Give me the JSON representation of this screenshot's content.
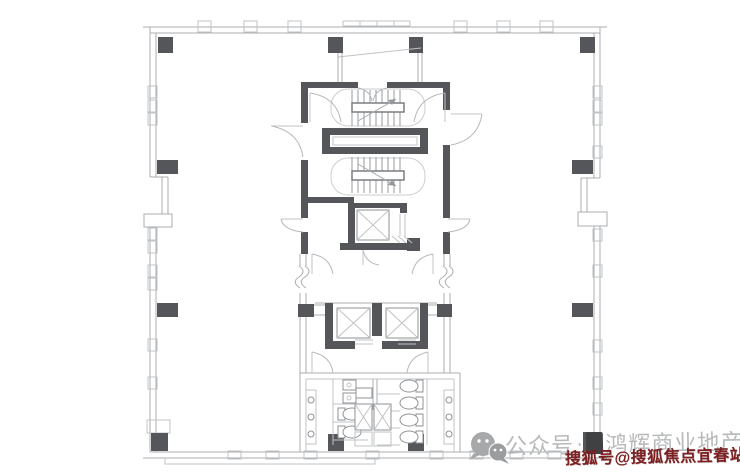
{
  "watermark": {
    "wechat_label": "公众号",
    "separator": "·",
    "brand": "鸿辉商业地产",
    "sohu_line": "搜狐号@搜狐焦点宜春站"
  },
  "icons": {
    "wechat": "wechat-chat-bubbles-icon",
    "sohu_logo": "dark-square-logo-block"
  },
  "colors": {
    "background": "#ffffff",
    "wall_dark": "#54565a",
    "line_light": "#a9acaf",
    "watermark_gray": "#b7b9bb",
    "watermark_red": "#7c2022"
  }
}
